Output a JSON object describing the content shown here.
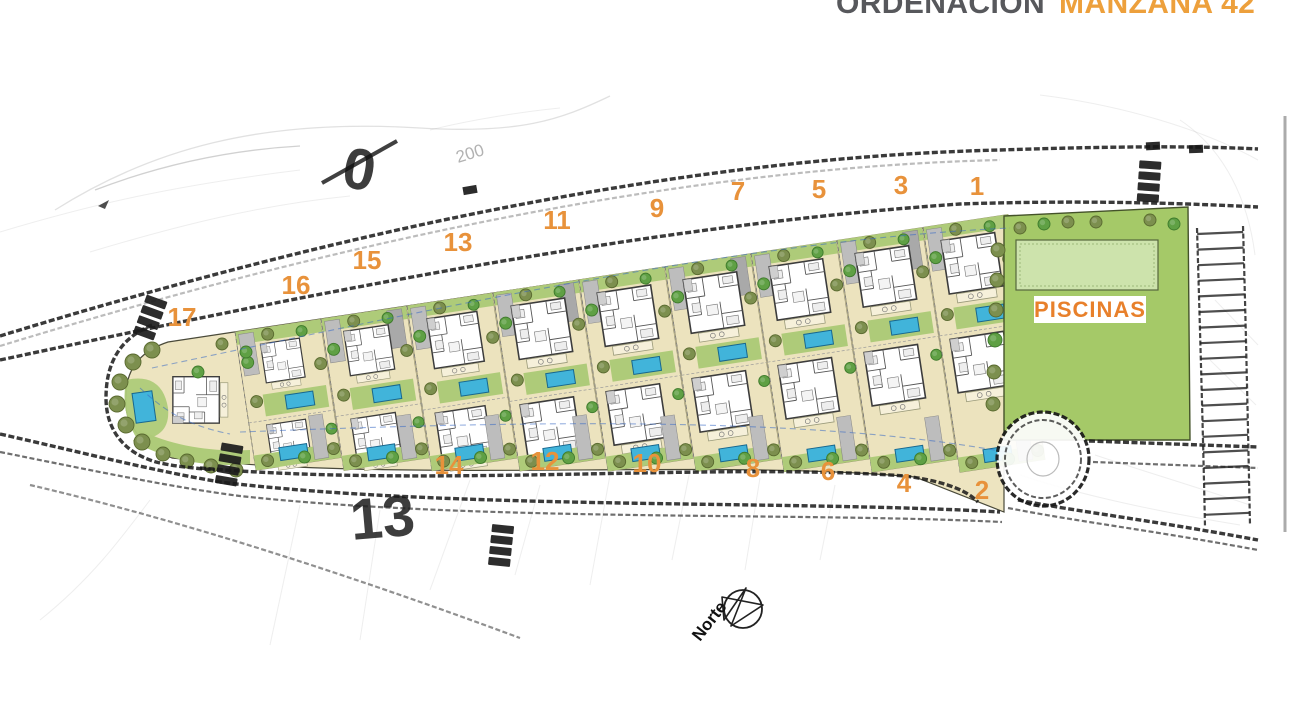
{
  "title": {
    "prefix": "ORDENACIÓN",
    "highlight": "MANZANA 42"
  },
  "plan": {
    "plot_labels": [
      {
        "n": "17",
        "x": 182,
        "y": 326
      },
      {
        "n": "16",
        "x": 296,
        "y": 294
      },
      {
        "n": "15",
        "x": 367,
        "y": 269
      },
      {
        "n": "13",
        "x": 458,
        "y": 251
      },
      {
        "n": "11",
        "x": 557,
        "y": 229
      },
      {
        "n": "9",
        "x": 657,
        "y": 217
      },
      {
        "n": "7",
        "x": 738,
        "y": 200
      },
      {
        "n": "5",
        "x": 819,
        "y": 198
      },
      {
        "n": "3",
        "x": 901,
        "y": 194
      },
      {
        "n": "1",
        "x": 977,
        "y": 195
      },
      {
        "n": "14",
        "x": 449,
        "y": 474
      },
      {
        "n": "12",
        "x": 545,
        "y": 470
      },
      {
        "n": "10",
        "x": 647,
        "y": 472
      },
      {
        "n": "8",
        "x": 753,
        "y": 477
      },
      {
        "n": "6",
        "x": 828,
        "y": 480
      },
      {
        "n": "4",
        "x": 904,
        "y": 492
      },
      {
        "n": "2",
        "x": 982,
        "y": 499
      }
    ],
    "pools_area_label": "PISCINAS",
    "compass_label": "Norte",
    "ghost_labels": {
      "big_number": "0",
      "contour_elevation": "200",
      "parcel_number": "13"
    }
  },
  "colors": {
    "accent_orange": "#E8923B",
    "title_gray": "#57585C",
    "plot_beige": "#ECE3BE",
    "garden_green": "#AECB79",
    "communal_green": "#A5C968",
    "pool_blue": "#41B4DA",
    "pool_deck_green": "#CDE3AC",
    "tree_olive": "#7C8F4E",
    "tree_green": "#5FA044",
    "driveway_gray": "#BDBDBD",
    "ink": "#1A1A1A"
  }
}
